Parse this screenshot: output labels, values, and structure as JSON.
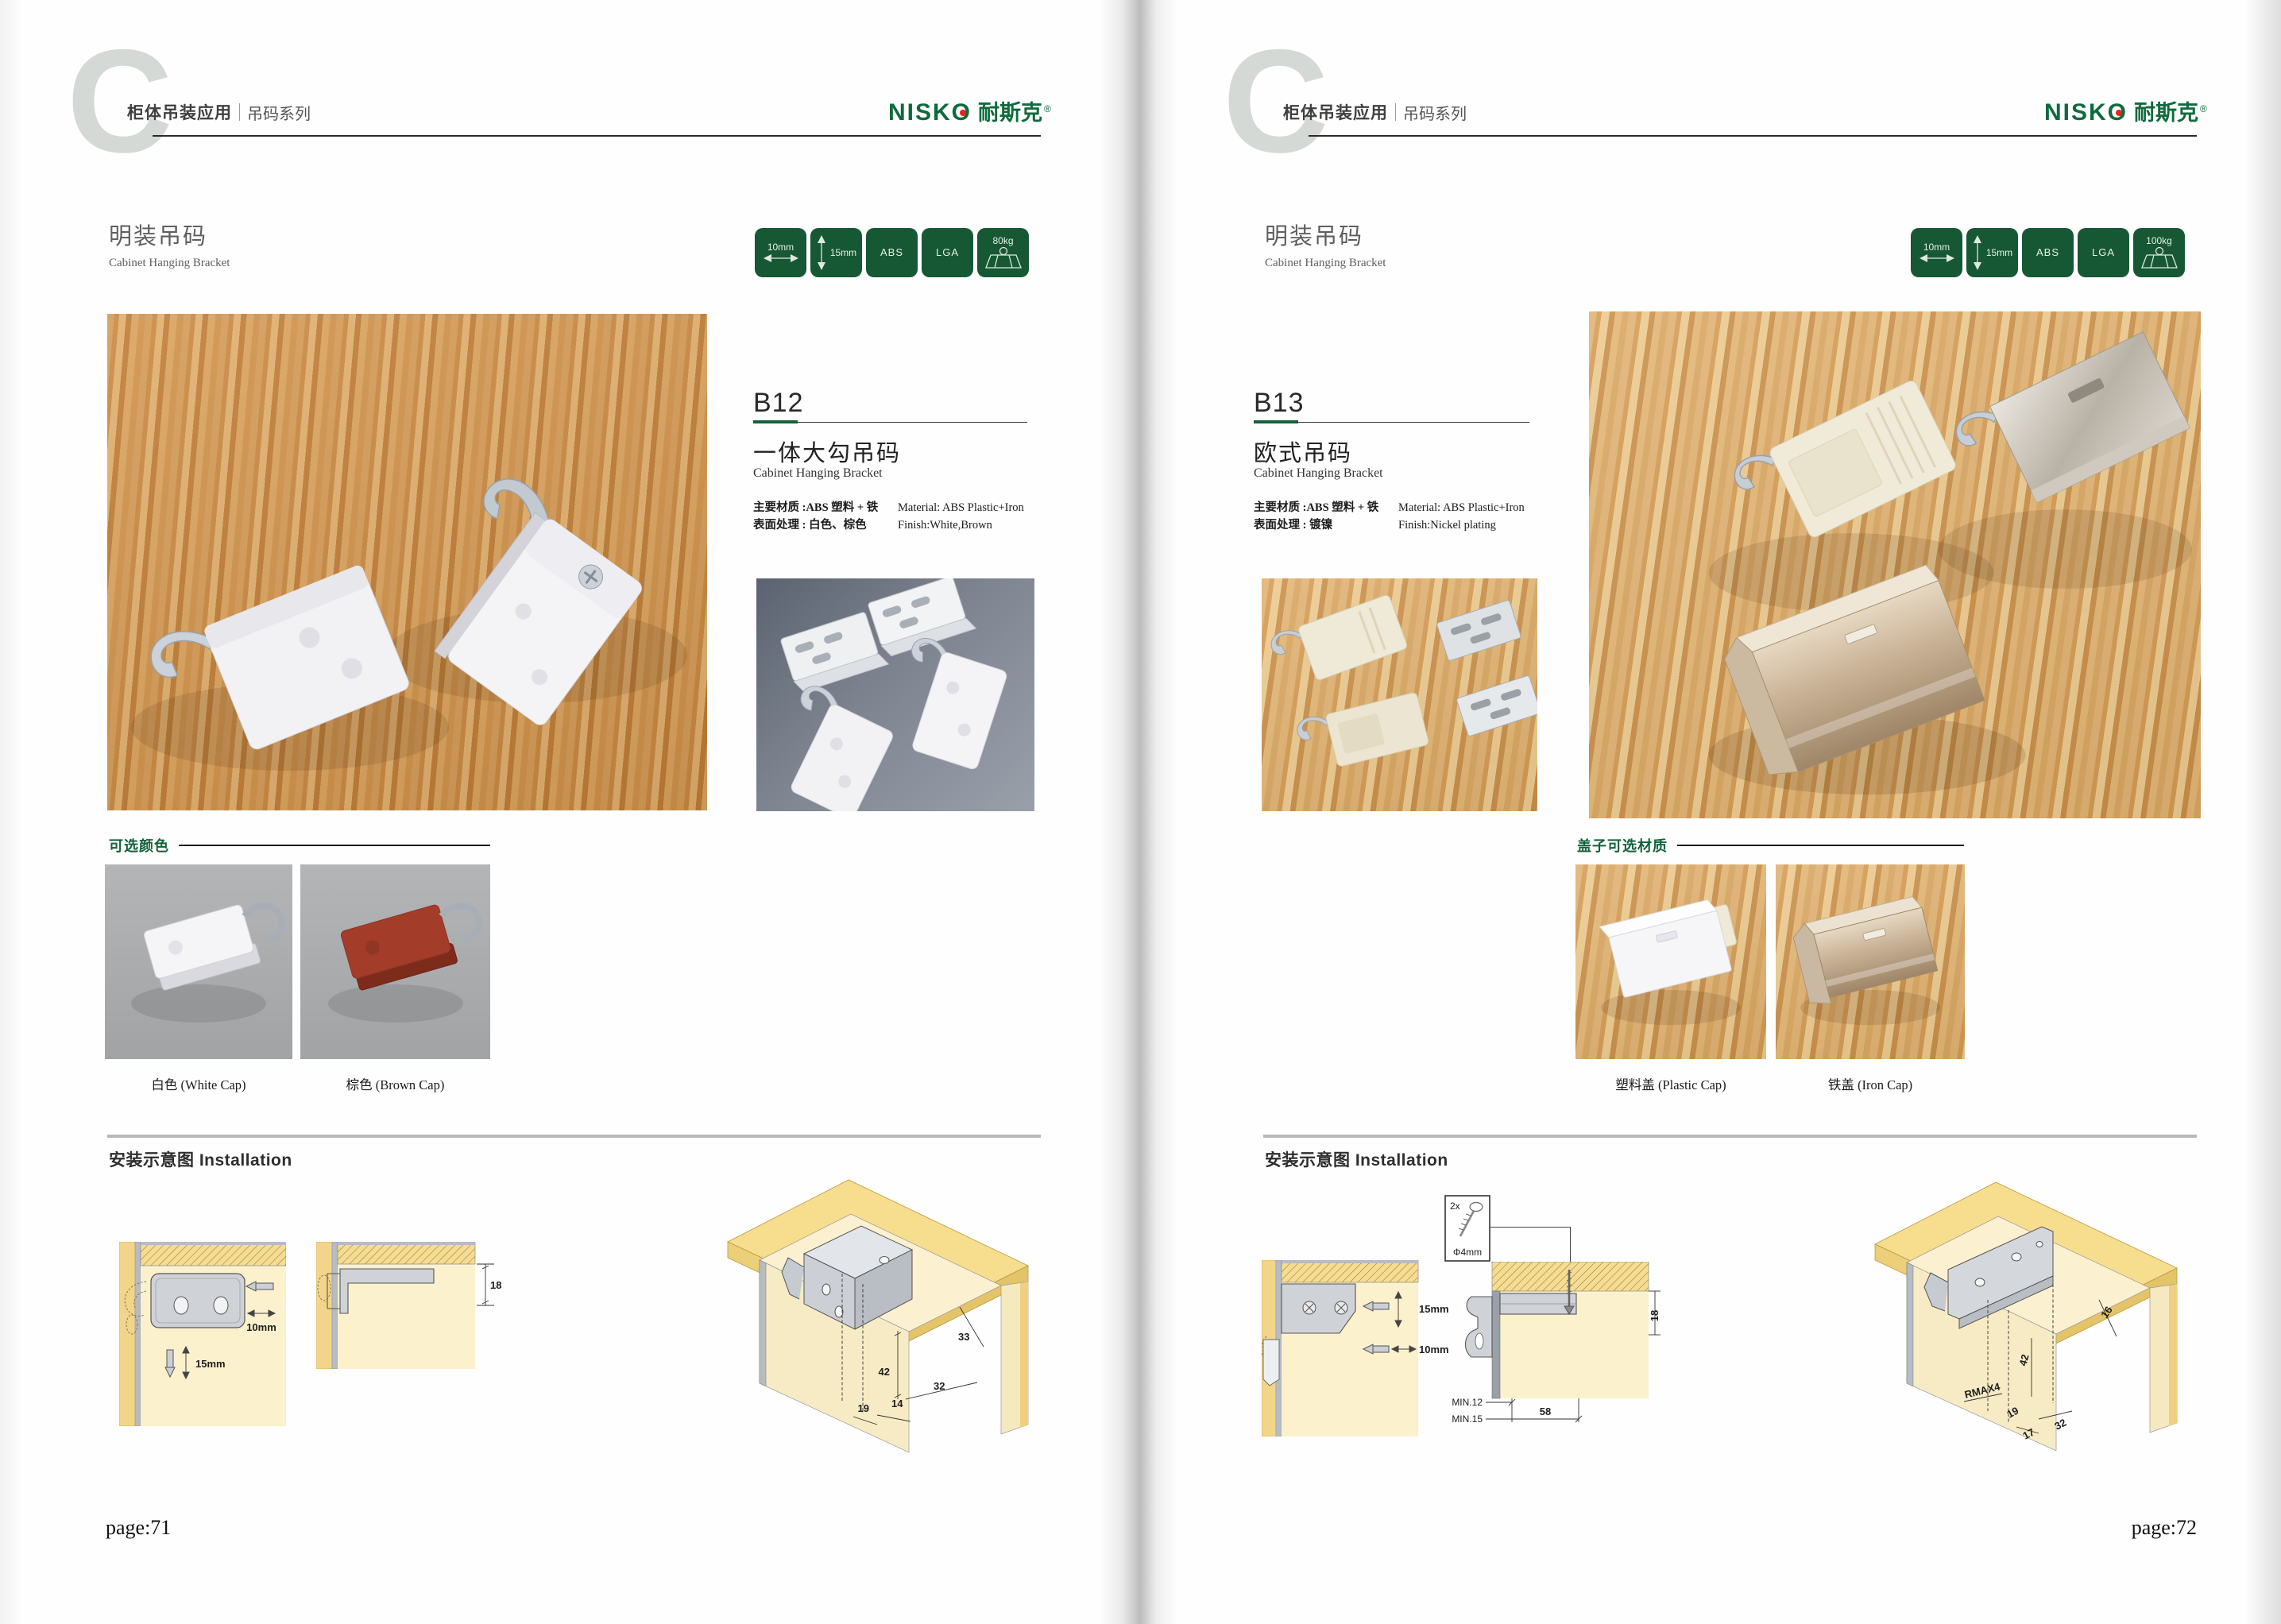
{
  "brand": {
    "en": "NISKO",
    "cn": "耐斯克",
    "reg": "®"
  },
  "colors": {
    "brand_green": "#0f6b3c",
    "badge_green": "#175834",
    "accent_green": "#14623a",
    "wood_left": "#cf9149",
    "wood_right": "#d8a55f",
    "swatch_gray": "#a9abad",
    "diagram_cream": "#fcf1cd",
    "diagram_wood": "#f2d588",
    "brown_cap": "#a33d2a"
  },
  "pages": [
    {
      "chapter_letter": "C",
      "header": {
        "title": "柜体吊装应用",
        "series": "吊码系列"
      },
      "section": {
        "title_cn": "明装吊码",
        "title_en": "Cabinet Hanging Bracket"
      },
      "badges": [
        {
          "label": "10mm",
          "icon": "width-arrow"
        },
        {
          "label": "15mm",
          "icon": "height-arrow"
        },
        {
          "label": "ABS",
          "icon": "none"
        },
        {
          "label": "LGA",
          "icon": "none"
        },
        {
          "label": "80kg",
          "icon": "load"
        }
      ],
      "product": {
        "code": "B12",
        "name_cn": "一体大勾吊码",
        "name_en": "Cabinet Hanging Bracket",
        "material_cn": "主要材质 :ABS 塑料 + 铁",
        "material_en": "Material: ABS Plastic+Iron",
        "finish_cn": "表面处理 : 白色、棕色",
        "finish_en": "Finish:White,Brown"
      },
      "options": {
        "label": "可选颜色",
        "items": [
          {
            "caption": "白色 (White Cap)"
          },
          {
            "caption": "棕色 (Brown Cap)"
          }
        ]
      },
      "installation": {
        "label": "安装示意图 Installation",
        "d1": {
          "dim_w": "10mm",
          "dim_h": "15mm"
        },
        "d2": {
          "dim": "18"
        },
        "persp": {
          "d1": "33",
          "d2": "42",
          "d3": "32",
          "d4": "14",
          "d5": "19"
        }
      },
      "page_label": "page:71"
    },
    {
      "chapter_letter": "C",
      "header": {
        "title": "柜体吊装应用",
        "series": "吊码系列"
      },
      "section": {
        "title_cn": "明装吊码",
        "title_en": "Cabinet Hanging Bracket"
      },
      "badges": [
        {
          "label": "10mm",
          "icon": "width-arrow"
        },
        {
          "label": "15mm",
          "icon": "height-arrow"
        },
        {
          "label": "ABS",
          "icon": "none"
        },
        {
          "label": "LGA",
          "icon": "none"
        },
        {
          "label": "100kg",
          "icon": "load"
        }
      ],
      "product": {
        "code": "B13",
        "name_cn": "欧式吊码",
        "name_en": "Cabinet Hanging Bracket",
        "material_cn": "主要材质 :ABS 塑料 + 铁",
        "material_en": "Material: ABS Plastic+Iron",
        "finish_cn": "表面处理 : 镀镍",
        "finish_en": "Finish:Nickel plating"
      },
      "options": {
        "label": "盖子可选材质",
        "items": [
          {
            "caption": "塑料盖 (Plastic Cap)"
          },
          {
            "caption": "铁盖 (Iron Cap)"
          }
        ]
      },
      "installation": {
        "label": "安装示意图 Installation",
        "screw": {
          "count": "2x",
          "size": "Φ4mm"
        },
        "d1": {
          "dim_h": "15mm",
          "dim_w": "10mm"
        },
        "d2": {
          "dim": "18",
          "min1": "MIN.12",
          "min2": "MIN.15",
          "span": "58"
        },
        "persp": {
          "d1": "16",
          "d2": "42",
          "d3": "RMAX4",
          "d4": "19",
          "d5": "17",
          "d6": "32"
        }
      },
      "page_label": "page:72"
    }
  ]
}
